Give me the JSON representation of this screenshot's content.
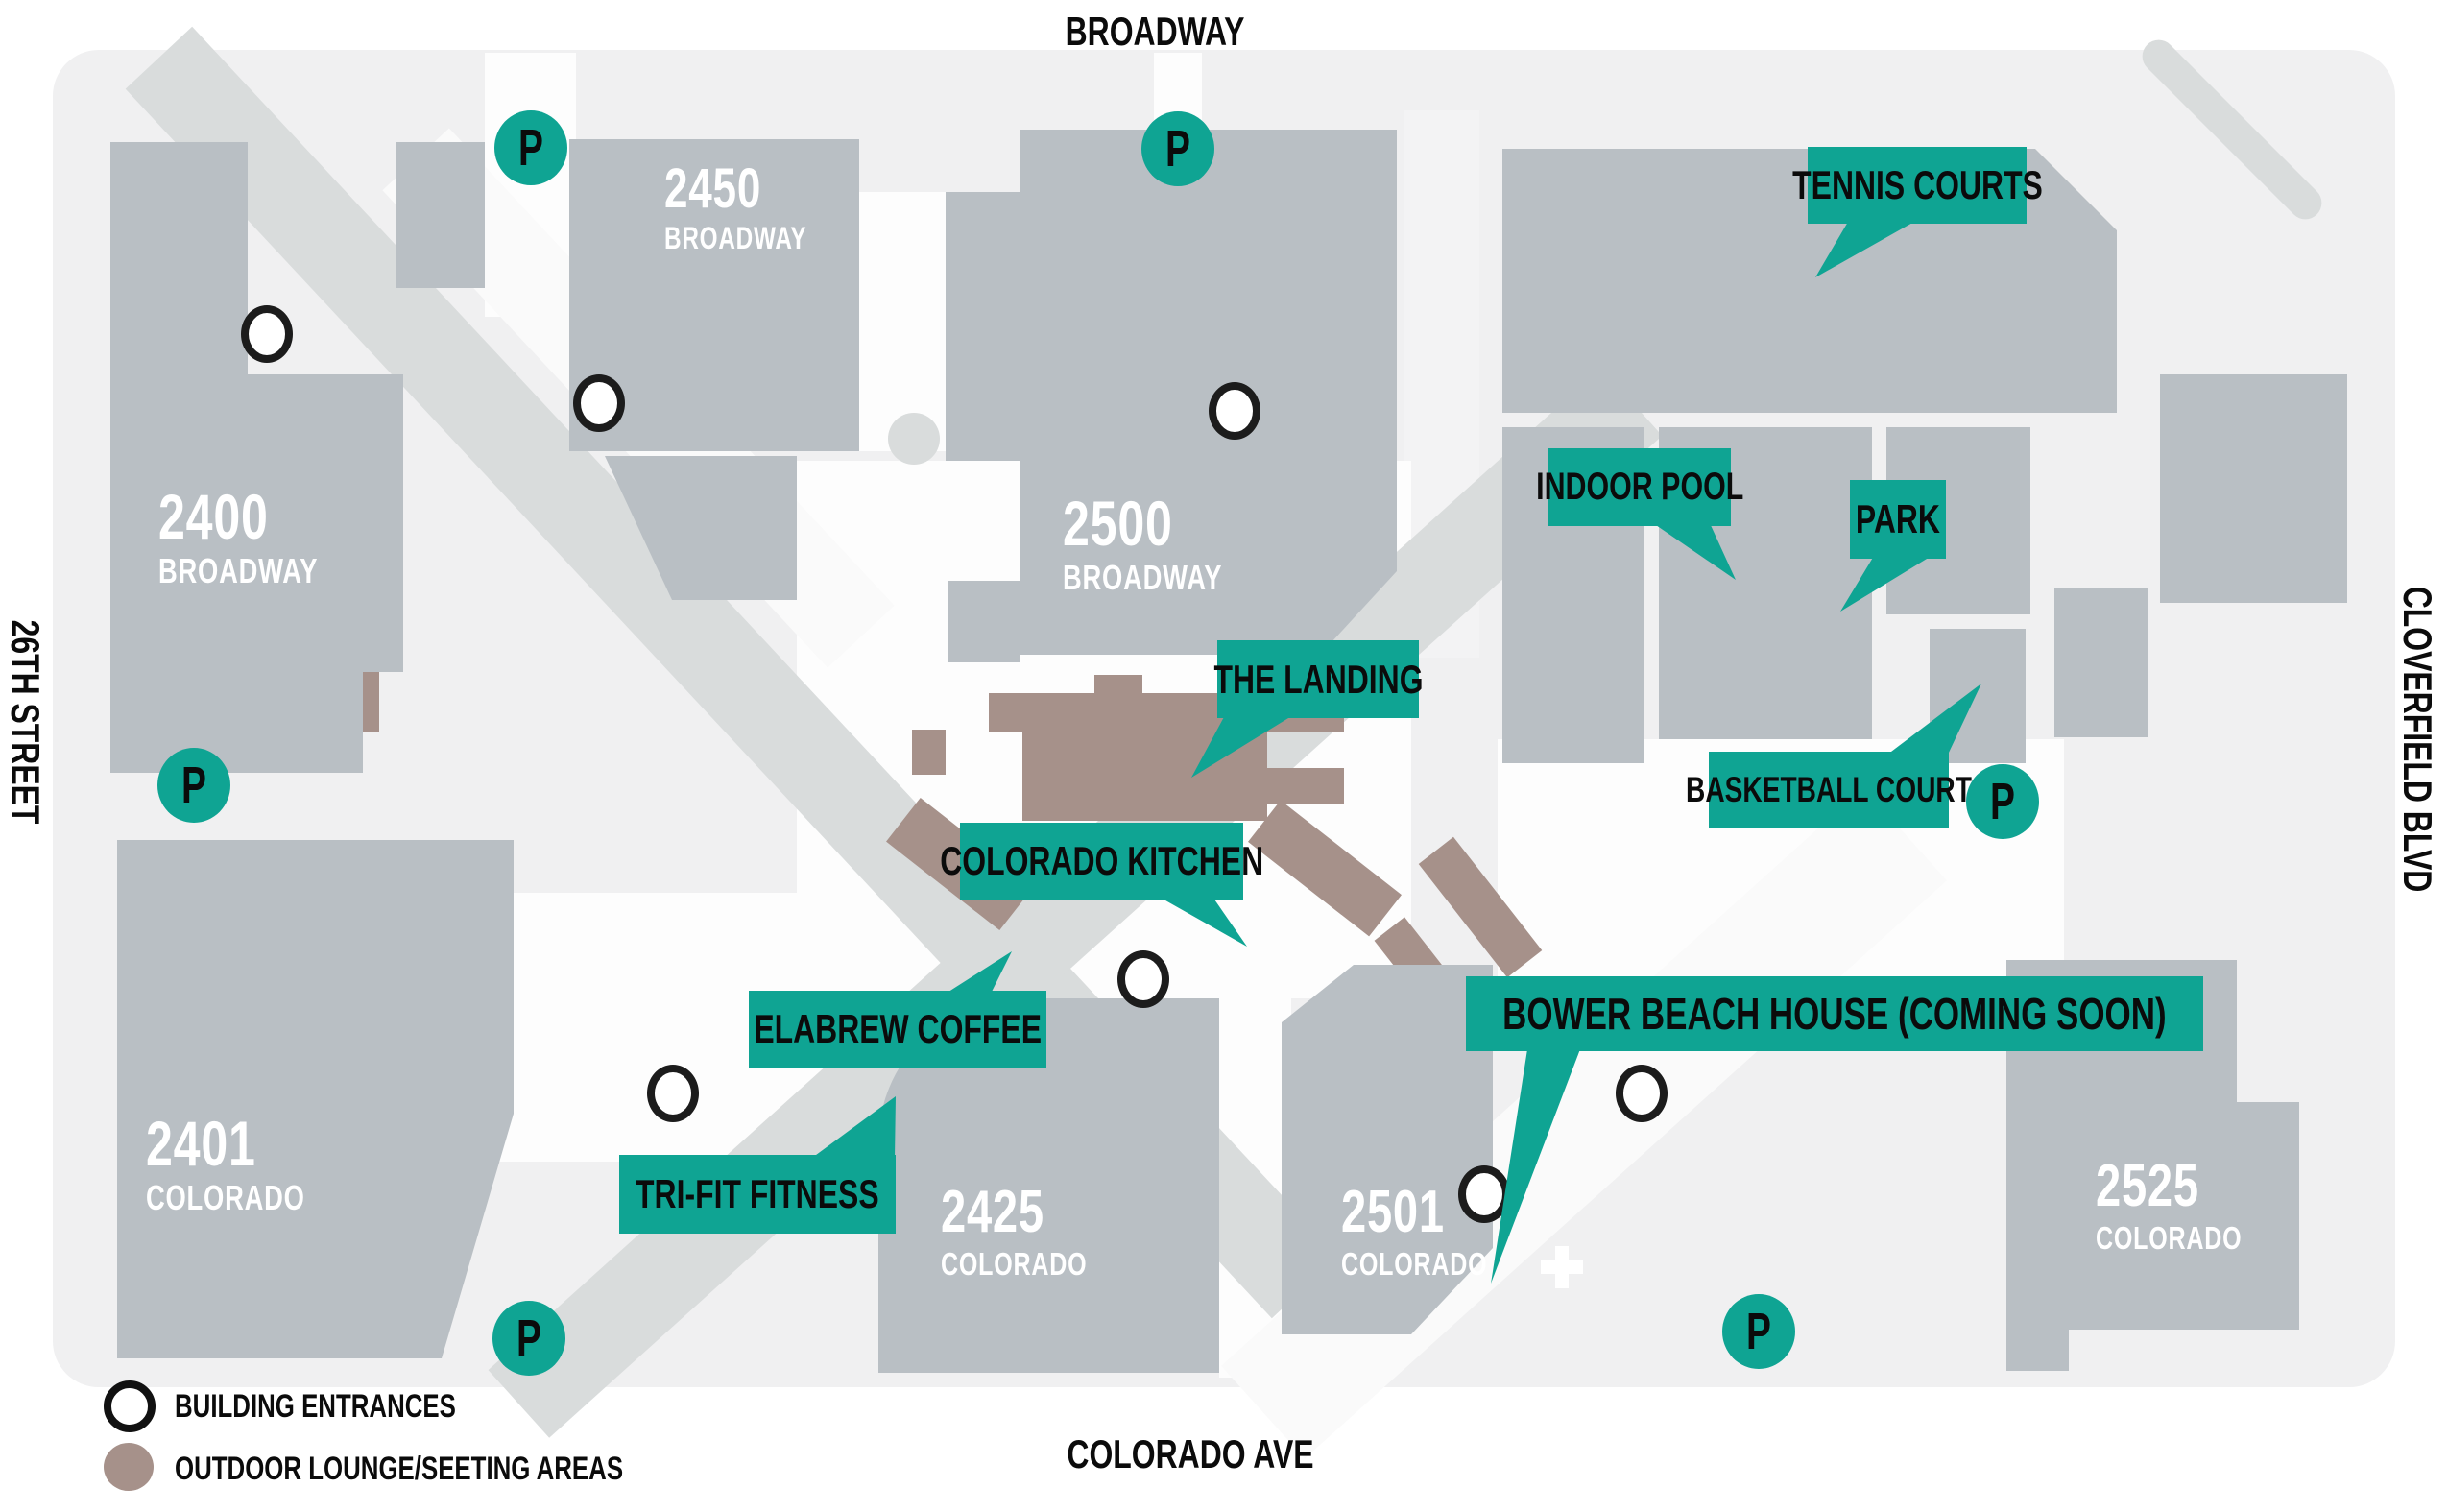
{
  "streets": {
    "top": "BROADWAY",
    "left": "26TH STREET",
    "right": "CLOVERFIELD BLVD",
    "bottom": "COLORADO AVE"
  },
  "buildings": [
    {
      "number": "2400",
      "street": "BROADWAY"
    },
    {
      "number": "2450",
      "street": "BROADWAY"
    },
    {
      "number": "2500",
      "street": "BROADWAY"
    },
    {
      "number": "2401",
      "street": "COLORADO"
    },
    {
      "number": "2425",
      "street": "COLORADO"
    },
    {
      "number": "2501",
      "street": "COLORADO"
    },
    {
      "number": "2525",
      "street": "COLORADO"
    }
  ],
  "amenities": [
    "TENNIS COURTS",
    "INDOOR POOL",
    "PARK",
    "THE LANDING",
    "BASKETBALL COURT",
    "COLORADO KITCHEN",
    "ELABREW COFFEE",
    "TRI-FIT FITNESS",
    "BOWER BEACH HOUSE (COMING SOON)"
  ],
  "parking": {
    "symbol": "P",
    "count": 6
  },
  "legend": {
    "items": [
      {
        "icon": "building-entrance-icon",
        "label": "BUILDING ENTRANCES"
      },
      {
        "icon": "outdoor-lounge-icon",
        "label": "OUTDOOR LOUNGE/SEETING AREAS"
      }
    ]
  },
  "colors": {
    "teal": "#0FA493",
    "building": "#B9BFC4",
    "brown": "#A6918A",
    "path": "#D9DCDC",
    "ground": "#F0F0F1"
  }
}
